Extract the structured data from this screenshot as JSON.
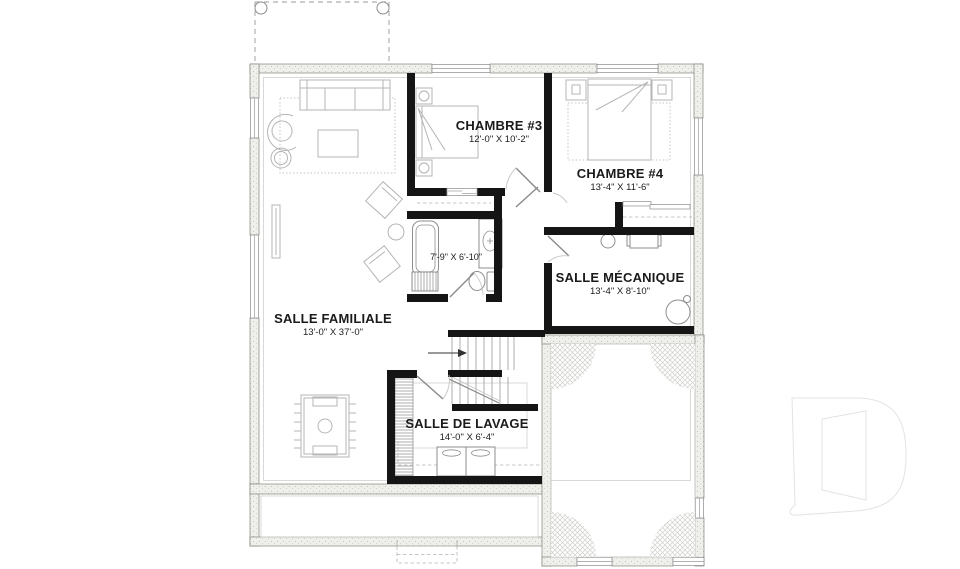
{
  "plan": {
    "rooms": [
      {
        "name": "CHAMBRE #3",
        "dims": "12'-0\" X 10'-2\""
      },
      {
        "name": "CHAMBRE #4",
        "dims": "13'-4\" X 11'-6\""
      },
      {
        "name": "SALLE MÉCANIQUE",
        "dims": "13'-4\" X 8'-10\""
      },
      {
        "name": "SALLE FAMILIALE",
        "dims": "13'-0\" X 37'-0\""
      },
      {
        "name": "SALLE DE LAVAGE",
        "dims": "14'-0\" X 6'-4\""
      }
    ],
    "bathroom": {
      "dims": "7'-9\" X 6'-10\""
    },
    "watermark_letter": "D",
    "colors": {
      "interior_wall": "#151515",
      "exterior_wall_fill": "#efefec",
      "furniture_line": "#b5b5b5",
      "fixture_line": "#8e8e8e",
      "hatch_line": "#cfcfcb",
      "watermark_line": "#e3e3e0"
    }
  }
}
